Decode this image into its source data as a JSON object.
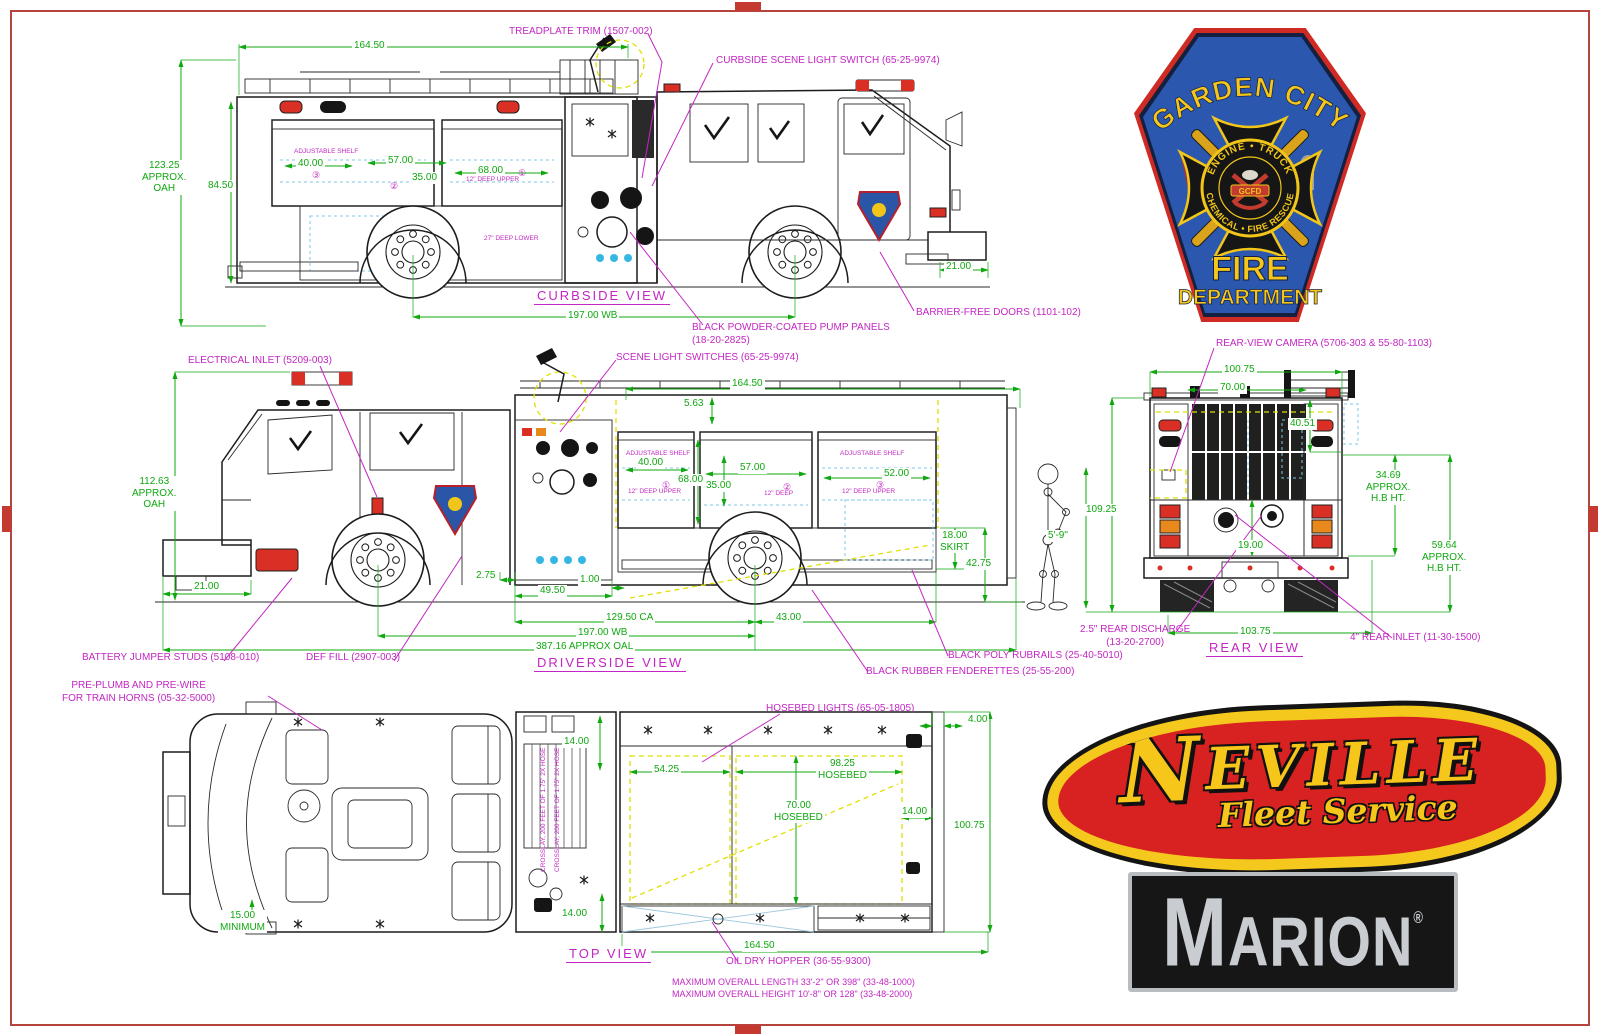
{
  "curbside": {
    "title": "CURBSIDE VIEW",
    "callouts": {
      "treadplate": "TREADPLATE TRIM (1507-002)",
      "scene_switch": "CURBSIDE SCENE LIGHT SWITCH (65-25-9974)",
      "pump_panels": "BLACK POWDER-COATED PUMP PANELS\n(18-20-2825)",
      "barrier_doors": "BARRIER-FREE DOORS (1101-102)"
    },
    "dims": {
      "length": "164.50",
      "oah": "123.25\nAPPROX.\nOAH",
      "body_height": "84.50",
      "c40": "40.00",
      "c57": "57.00",
      "c35": "35.00",
      "c68": "68.00",
      "wb": "197.00 WB",
      "front": "21.00"
    },
    "notes": {
      "shelf": "ADJUSTABLE SHELF",
      "deep_upper": "12\" DEEP UPPER",
      "deep_lower": "27\" DEEP LOWER",
      "n1": "①",
      "n2": "②",
      "n3": "③"
    }
  },
  "driverside": {
    "title": "DRIVERSIDE VIEW",
    "callouts": {
      "electrical": "ELECTRICAL INLET (5209-003)",
      "scene_switches": "SCENE LIGHT SWITCHES (65-25-9974)",
      "battery": "BATTERY JUMPER STUDS (5108-010)",
      "def_fill": "DEF FILL (2907-003)",
      "rubrails": "BLACK POLY RUBRAILS (25-40-5010)",
      "fenderettes": "BLACK RUBBER FENDERETTES (25-55-200)"
    },
    "dims": {
      "length": "164.50",
      "d563": "5.63",
      "oah": "112.63\nAPPROX.\nOAH",
      "front": "21.00",
      "d275": "2.75",
      "d4950": "49.50",
      "d100": "1.00",
      "ca": "129.50 CA",
      "wb": "197.00 WB",
      "oal": "387.16 APPROX OAL",
      "d4300": "43.00",
      "skirt": "18.00\nSKIRT",
      "d4275": "42.75",
      "c40": "40.00",
      "c68": "68.00",
      "c57": "57.00",
      "c35": "35.00",
      "c52": "52.00"
    },
    "notes": {
      "shelf1": "ADJUSTABLE SHELF",
      "deep_upper1": "12\" DEEP UPPER",
      "deep2": "12\" DEEP",
      "shelf3": "ADJUSTABLE SHELF",
      "deep_upper3": "12\" DEEP UPPER",
      "n1": "①",
      "n2": "②",
      "n3": "③"
    }
  },
  "rear": {
    "title": "REAR VIEW",
    "callouts": {
      "camera": "REAR-VIEW CAMERA (5706-303 & 55-80-1103)",
      "discharge": "2.5\" REAR DISCHARGE\n(13-20-2700)",
      "inlet": "4\" REAR INLET (11-30-1500)"
    },
    "dims": {
      "w10075": "100.75",
      "w7000": "70.00",
      "d4051": "40.51",
      "oah": "109.25",
      "mannequin": "5'-9\"",
      "hb1": "34.69\nAPPROX.\nH.B HT.",
      "hb2": "59.64\nAPPROX.\nH.B HT.",
      "d1900": "19.00",
      "w10375": "103.75"
    }
  },
  "top": {
    "title": "TOP VIEW",
    "callouts": {
      "train_horns": "PRE-PLUMB AND PRE-WIRE\nFOR TRAIN HORNS (05-32-5000)",
      "hosebed_lights": "HOSEBED LIGHTS (65-05-1805)",
      "oil_dry": "OIL DRY HOPPER (36-55-9300)"
    },
    "dims": {
      "d1400a": "14.00",
      "d5425": "54.25",
      "hosebed_l": "98.25\nHOSEBED",
      "hosebed_w": "70.00\nHOSEBED",
      "d1400b": "14.00",
      "w10075": "100.75",
      "d400": "4.00",
      "min": "15.00\nMINIMUM",
      "d1400c": "14.00",
      "length": "164.50"
    },
    "notes": {
      "max_length": "MAXIMUM OVERALL LENGTH 33'-2\" OR 398\" (33-48-1000)",
      "max_height": "MAXIMUM OVERALL HEIGHT 10'-8\" OR 128\" (33-48-2000)",
      "crosslay": "CROSSLAY, 200 FEET OF 1.75\" 2X HOSE"
    }
  },
  "badge": {
    "city": "GARDEN CITY",
    "ring_top": "ENGINE • TRUCK",
    "ring_bottom": "CHEMICAL • FIRE RESCUE",
    "center": "GCFD",
    "fire": "FIRE",
    "department": "DEPARTMENT"
  },
  "neville": {
    "initial": "N",
    "rest": "EVILLE",
    "tagline": "Fleet Service"
  },
  "marion": {
    "initial": "M",
    "rest": "ARION",
    "reg": "®"
  },
  "colors": {
    "dim_green": "#0fa80f",
    "callout_magenta": "#c326c3",
    "frame_red": "#b5443c"
  }
}
